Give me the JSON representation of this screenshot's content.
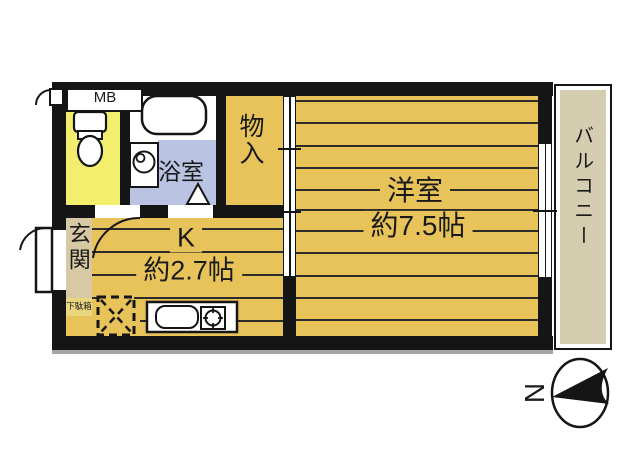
{
  "floorplan": {
    "labels": {
      "mb": "MB",
      "bath": "浴室",
      "storage": "物入",
      "western_room": "洋室",
      "western_room_size": "約7.5帖",
      "kitchen": "K",
      "kitchen_size": "約2.7帖",
      "entrance": "玄関",
      "shoe_box": "下駄箱",
      "balcony": "バルコニー",
      "compass_north": "N"
    },
    "colors": {
      "room": "#e8c35a",
      "toilet": "#f3ee6e",
      "bath_floor": "#bac3e2",
      "entrance": "#d6c9a4",
      "shoe_box": "#e9d67f",
      "balcony": "#d5cdb0",
      "wall": "#151515"
    }
  }
}
